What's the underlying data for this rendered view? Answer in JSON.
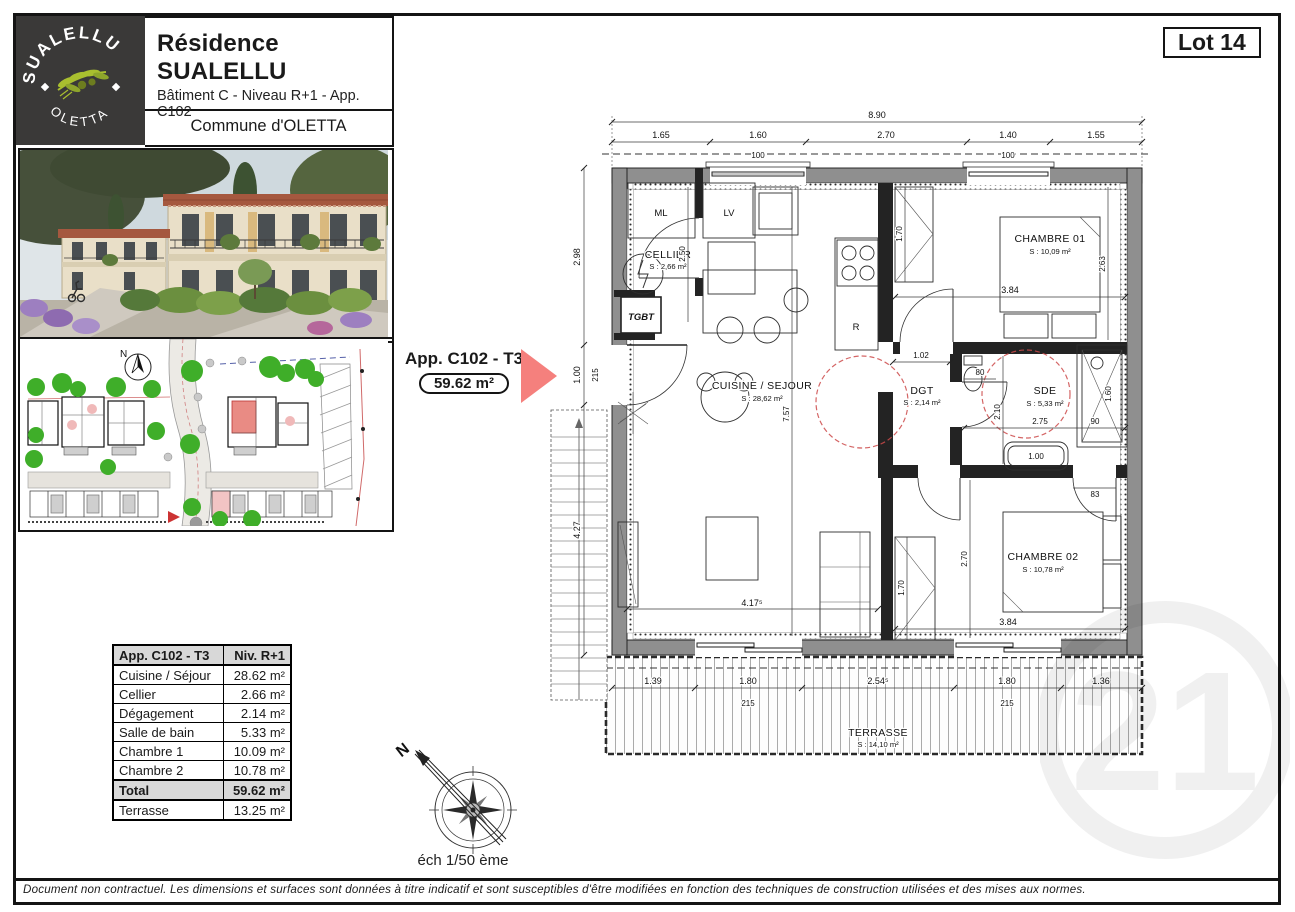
{
  "colors": {
    "accent_red": "#F5807D",
    "logo_background": "#3A3938",
    "logo_green": "#A9BF2F",
    "wall_gray": "#8F8F8F",
    "table_header_gray": "#D8D8D8",
    "siteplan_highlight": "#E98B84"
  },
  "branding": {
    "arc_top": "SUALELLU",
    "arc_bottom": "OLETTA"
  },
  "header": {
    "title": "Résidence SUALELLU",
    "subtitle": "Bâtiment C - Niveau R+1 - App. C102",
    "commune": "Commune d'OLETTA",
    "lot": "Lot 14"
  },
  "callout": {
    "name": "App. C102 - T3",
    "area": "59.62 m²"
  },
  "surface_table": {
    "header": {
      "left": "App. C102 - T3",
      "right": "Niv. R+1"
    },
    "rows": [
      {
        "label": "Cuisine / Séjour",
        "value": "28.62 m²"
      },
      {
        "label": "Cellier",
        "value": "2.66 m²"
      },
      {
        "label": "Dégagement",
        "value": "2.14 m²"
      },
      {
        "label": "Salle de bain",
        "value": "5.33 m²"
      },
      {
        "label": "Chambre 1",
        "value": "10.09 m²"
      },
      {
        "label": "Chambre 2",
        "value": "10.78 m²"
      }
    ],
    "total": {
      "label": "Total",
      "value": "59.62 m²"
    },
    "terrace": {
      "label": "Terrasse",
      "value": "13.25 m²"
    }
  },
  "scale": {
    "text": "éch 1/50 ème",
    "north": "N"
  },
  "plan": {
    "rooms": {
      "cellier": {
        "name": "CELLIER",
        "area": "S : 2,66 m²"
      },
      "cuisine": {
        "name": "CUISINE / SEJOUR",
        "area": "S : 28,62 m²"
      },
      "chambre1": {
        "name": "CHAMBRE 01",
        "area": "S : 10,09 m²"
      },
      "chambre2": {
        "name": "CHAMBRE 02",
        "area": "S : 10,78 m²"
      },
      "dgt": {
        "name": "DGT",
        "area": "S : 2,14 m²"
      },
      "sde": {
        "name": "SDE",
        "area": "S : 5,33 m²"
      },
      "terrasse": {
        "name": "TERRASSE",
        "area": "S : 14,10 m²"
      }
    },
    "appliances": {
      "ml": "ML",
      "lv": "LV",
      "r": "R",
      "tgbt": "TGBT"
    },
    "dims": {
      "top_total": "8.90",
      "top": [
        "1.65",
        "1.60",
        "2.70",
        "1.40",
        "1.55"
      ],
      "top_sills": [
        "100",
        "100"
      ],
      "left": [
        "2.98",
        "1.00",
        "4.27"
      ],
      "left_sill": "215",
      "bottom": [
        "1.39",
        "1.80",
        "2.54⁵",
        "1.80",
        "1.36"
      ],
      "bottom_sills": [
        "215",
        "215"
      ],
      "cellier_h": "2.50",
      "sejour_h": "7.57",
      "sejour_w": "4.17⁵",
      "ch1": [
        "1.70",
        "2.63",
        "3.84"
      ],
      "ch2": [
        "1.70",
        "2.70",
        "3.84"
      ],
      "sde": [
        "1.02",
        "80",
        "2.10",
        "2.75",
        "90",
        "1.60",
        "1.00",
        "83"
      ]
    }
  },
  "watermark": {
    "text": "21"
  },
  "footer": {
    "disclaimer": "Document non contractuel. Les dimensions et surfaces sont données à titre indicatif et sont susceptibles d'être modifiées en fonction des techniques de construction utilisées et des mises aux normes."
  }
}
